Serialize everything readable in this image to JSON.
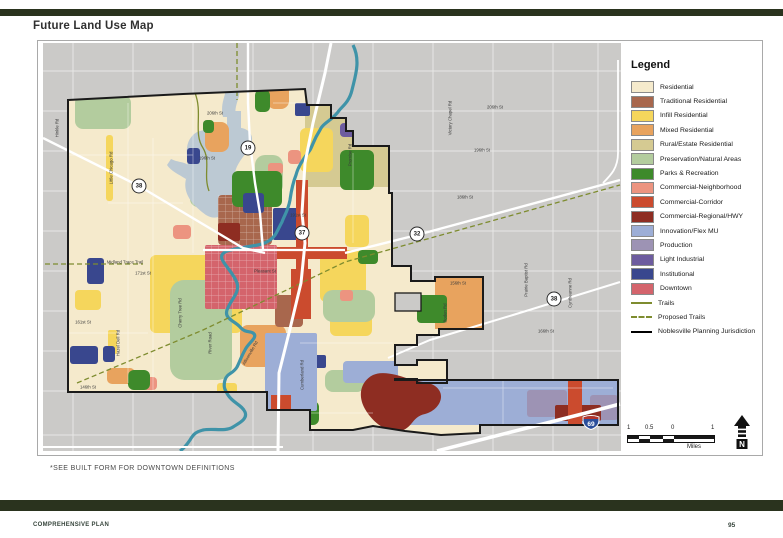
{
  "page": {
    "title": "Future Land Use Map",
    "map_note": "*SEE BUILT FORM FOR DOWNTOWN DEFINITIONS",
    "footer_left": "COMPREHENSIVE PLAN",
    "page_number": "95",
    "accent_bar_color": "#2A331E"
  },
  "legend": {
    "title": "Legend",
    "items": [
      {
        "label": "Residential",
        "color": "#F5EACC"
      },
      {
        "label": "Traditional Residential",
        "color": "#A8674D"
      },
      {
        "label": "Infill Residential",
        "color": "#F5D65C"
      },
      {
        "label": "Mixed Residential",
        "color": "#E8A35E"
      },
      {
        "label": "Rural/Estate Residential",
        "color": "#D5CA92"
      },
      {
        "label": "Preservation/Natural Areas",
        "color": "#B3CC9E"
      },
      {
        "label": "Parks & Recreation",
        "color": "#3E8A2B"
      },
      {
        "label": "Commercial-Neighborhood",
        "color": "#EC9480"
      },
      {
        "label": "Commercial-Corridor",
        "color": "#CB4B2E"
      },
      {
        "label": "Commercial-Regional/HWY",
        "color": "#8E2D22"
      },
      {
        "label": "Innovation/Flex MU",
        "color": "#9DAED6"
      },
      {
        "label": "Production",
        "color": "#9D93B4"
      },
      {
        "label": "Light Industrial",
        "color": "#6D5C9F"
      },
      {
        "label": "Institutional",
        "color": "#39478E"
      },
      {
        "label": "Downtown",
        "color": "#D4646C"
      }
    ],
    "line_items": [
      {
        "label": "Trails",
        "style": "solid",
        "color": "#7E8C2F"
      },
      {
        "label": "Proposed Trails",
        "style": "dashed",
        "color": "#7E8C2F"
      },
      {
        "label": "Noblesville Planning Jurisdiction",
        "style": "solid-thick",
        "color": "#000000"
      }
    ]
  },
  "scale_bar": {
    "tick_labels": [
      "1",
      "0.5",
      "0",
      "1"
    ],
    "unit": "Miles"
  },
  "north_arrow": {
    "label": "N"
  },
  "map": {
    "water_color": "#3F93A8",
    "lake_color": "#BCC9D3",
    "outside_color": "#CBCAC8",
    "shields": [
      {
        "number": "19",
        "type": "state",
        "x": 205,
        "y": 105
      },
      {
        "number": "38",
        "type": "state",
        "x": 96,
        "y": 143
      },
      {
        "number": "37",
        "type": "state",
        "x": 259,
        "y": 190
      },
      {
        "number": "32",
        "type": "state",
        "x": 374,
        "y": 191
      },
      {
        "number": "38",
        "type": "state",
        "x": 511,
        "y": 256
      },
      {
        "number": "69",
        "type": "interstate",
        "x": 539,
        "y": 371
      }
    ],
    "road_labels": [
      {
        "text": "206th St",
        "x": 172,
        "y": 70,
        "rot": 0
      },
      {
        "text": "196th St",
        "x": 164,
        "y": 115,
        "rot": 0
      },
      {
        "text": "191st St",
        "x": 255,
        "y": 172,
        "rot": 0
      },
      {
        "text": "171st St",
        "x": 100,
        "y": 230,
        "rot": 0
      },
      {
        "text": "161st St",
        "x": 40,
        "y": 279,
        "rot": 0
      },
      {
        "text": "146th St",
        "x": 45,
        "y": 344,
        "rot": 0
      },
      {
        "text": "206th St",
        "x": 452,
        "y": 64,
        "rot": 0
      },
      {
        "text": "196th St",
        "x": 439,
        "y": 107,
        "rot": 0
      },
      {
        "text": "186th St",
        "x": 422,
        "y": 154,
        "rot": 0
      },
      {
        "text": "156th St",
        "x": 415,
        "y": 240,
        "rot": 0
      },
      {
        "text": "166th St",
        "x": 503,
        "y": 288,
        "rot": 0
      },
      {
        "text": "Pleasant St",
        "x": 222,
        "y": 228,
        "rot": 0
      },
      {
        "text": "Midland Trace Trail",
        "x": 82,
        "y": 219,
        "rot": 0
      },
      {
        "text": "Hinkle Rd",
        "x": 14,
        "y": 85,
        "rot": -90
      },
      {
        "text": "Little Chicago Rd",
        "x": 68,
        "y": 125,
        "rot": -90
      },
      {
        "text": "Promise Rd",
        "x": 307,
        "y": 112,
        "rot": -90
      },
      {
        "text": "Victory Chapel Rd",
        "x": 407,
        "y": 75,
        "rot": -90
      },
      {
        "text": "Cyntheanne Rd",
        "x": 527,
        "y": 250,
        "rot": -90
      },
      {
        "text": "Prairie Baptist Rd",
        "x": 483,
        "y": 237,
        "rot": -90
      },
      {
        "text": "Boden Rd",
        "x": 402,
        "y": 270,
        "rot": -90
      },
      {
        "text": "Cumberland Rd",
        "x": 259,
        "y": 332,
        "rot": -90
      },
      {
        "text": "Hazel Dell Rd",
        "x": 75,
        "y": 300,
        "rot": -90
      },
      {
        "text": "River Road",
        "x": 167,
        "y": 300,
        "rot": -90
      },
      {
        "text": "Cherry Tree Rd",
        "x": 137,
        "y": 270,
        "rot": -90
      },
      {
        "text": "Allisonville Rd",
        "x": 207,
        "y": 310,
        "rot": -60
      }
    ]
  }
}
